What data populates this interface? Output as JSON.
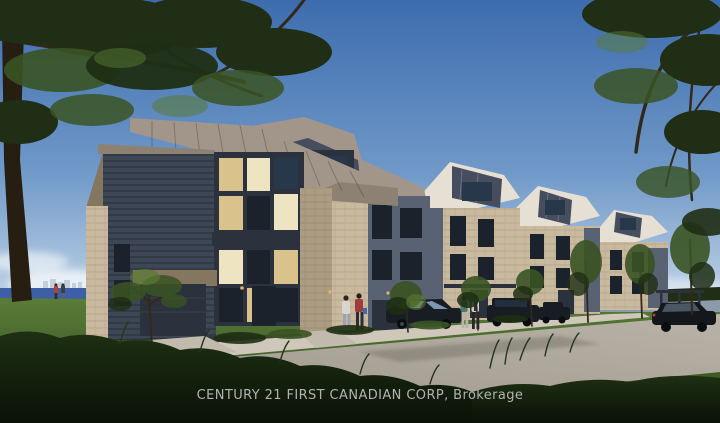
{
  "watermark": {
    "text": "CENTURY 21 FIRST CANADIAN CORP, Brokerage"
  },
  "colors": {
    "sky_top": "#3d6cae",
    "sky_mid": "#7099c8",
    "sky_horizon": "#c9d9ea",
    "cloud": "#eef3f8",
    "water_left": "#3d5fa6",
    "water_right": "#8d9aa8",
    "city": "#c3cfdb",
    "lawn_light": "#5a7d38",
    "lawn_dark": "#2c451d",
    "grass_fg_top": "#1e3013",
    "grass_fg_bottom": "#0a1207",
    "road": "#a09a8e",
    "road_far": "#b9b3a7",
    "sidewalk": "#cfc8ba",
    "roof_lit": "#a2968a",
    "roof_mid": "#8c8172",
    "roof_shadow": "#454d5e",
    "roof_far_lit": "#e6e0d4",
    "stone_lit": "#c9b99e",
    "stone_mid": "#ab9c82",
    "stone_shadow": "#84765f",
    "siding_dark": "#3d4654",
    "panel_gray": "#596273",
    "fascia": "#2b323d",
    "window_dark": "#1b222c",
    "window_blue": "#27384a",
    "window_glow": "#d9c28c",
    "window_glow_bright": "#efe4c2",
    "tree_dark": "#1f2e14",
    "tree_mid": "#3a5323",
    "tree_light": "#5a7a33",
    "trunk": "#261e11",
    "branch": "#33291a",
    "car_dark": "#181d24",
    "car_glass": "#7e96ad",
    "wheel": "#0b0e11",
    "light_amber": "#e8b066",
    "watermark": "#b2b2b2"
  }
}
